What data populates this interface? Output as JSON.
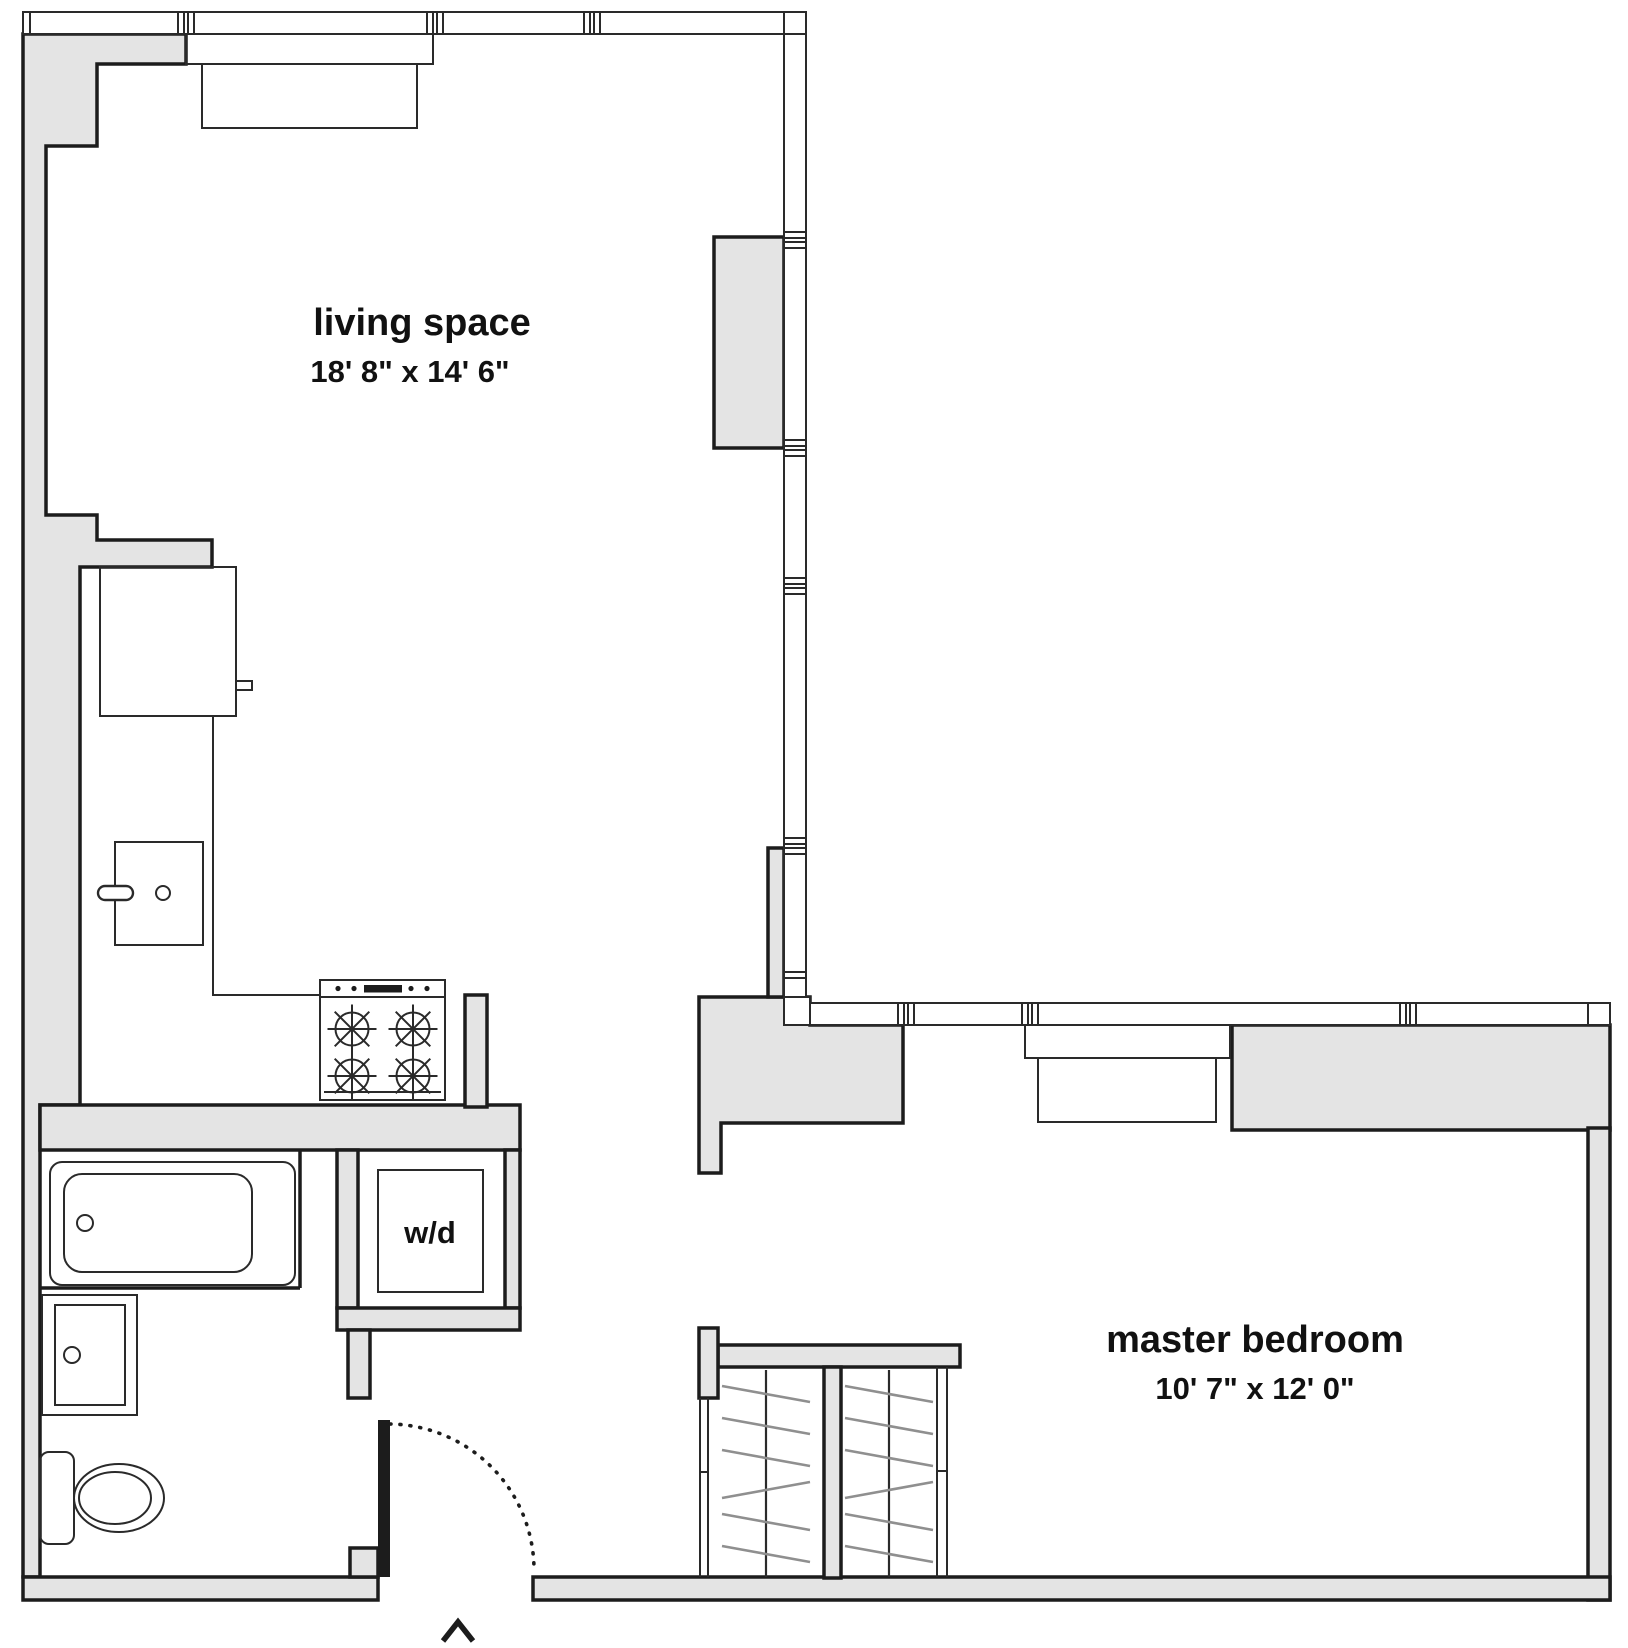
{
  "plan": {
    "type": "apartment floor plan",
    "entry_marker": "^"
  },
  "rooms": {
    "living_space": {
      "label": "living space",
      "dims": "18' 8\" x 14' 6\""
    },
    "master_bedroom": {
      "label": "master bedroom",
      "dims": "10' 7\" x 12' 0\""
    },
    "washer_dryer": {
      "label": "w/d"
    }
  },
  "fixtures": [
    "bathtub",
    "bathroom-sink",
    "toilet",
    "kitchen-sink",
    "refrigerator",
    "stove-4-burners",
    "washer-dryer",
    "closet-left",
    "closet-right",
    "entry-door-swing",
    "window-radiator-living",
    "window-radiator-bedroom"
  ],
  "colors": {
    "wall_fill": "#e4e4e4",
    "line": "#1c1c1c",
    "hanger_line": "#8f8f8f",
    "background": "#ffffff"
  }
}
